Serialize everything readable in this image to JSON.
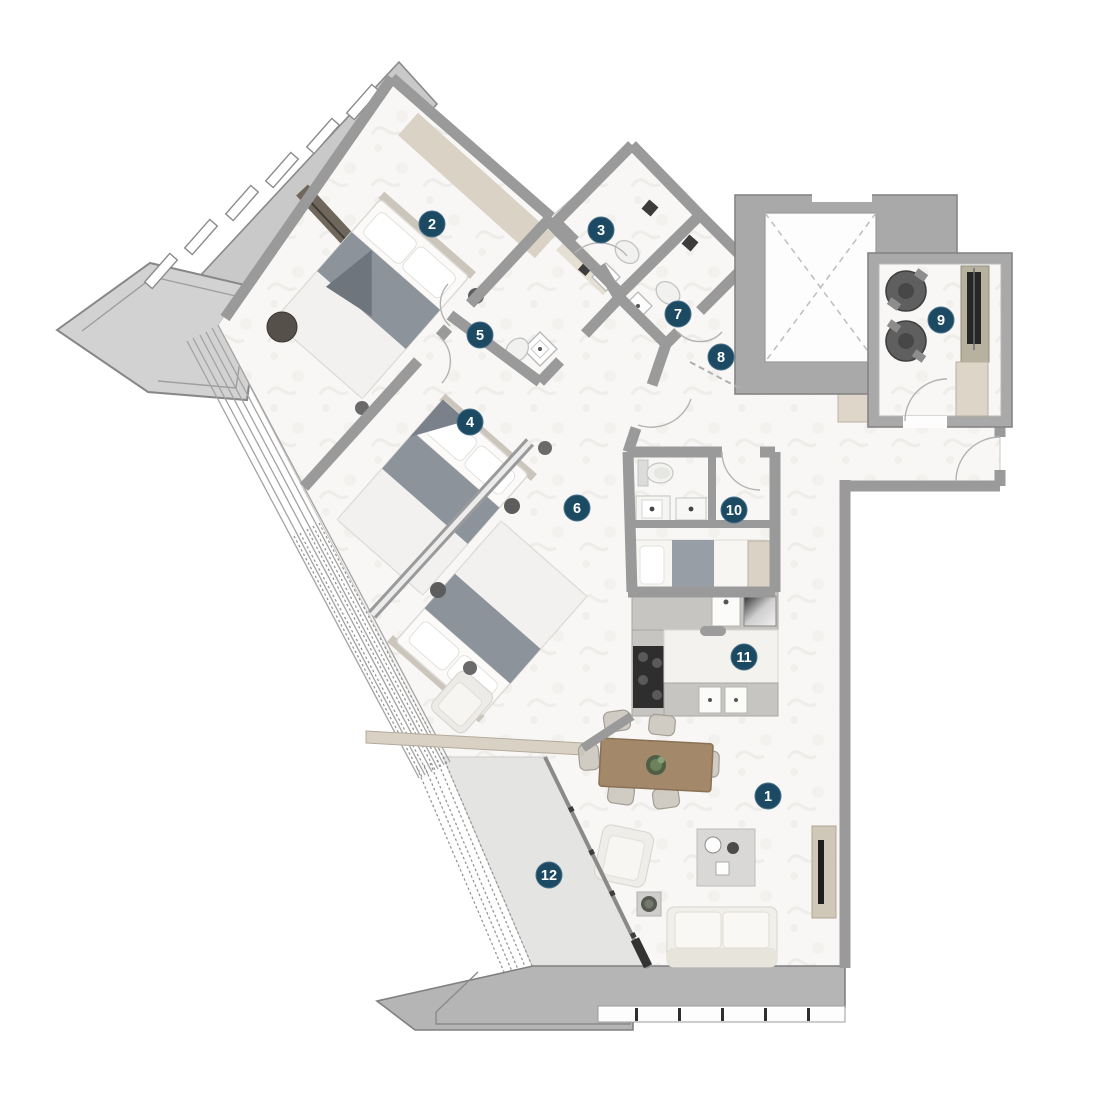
{
  "floorplan": {
    "markers": [
      {
        "n": "1"
      },
      {
        "n": "2"
      },
      {
        "n": "3"
      },
      {
        "n": "4"
      },
      {
        "n": "5"
      },
      {
        "n": "6"
      },
      {
        "n": "7"
      },
      {
        "n": "8"
      },
      {
        "n": "9"
      },
      {
        "n": "10"
      },
      {
        "n": "11"
      },
      {
        "n": "12"
      }
    ],
    "colors": {
      "marker_badge": "#1d4a63",
      "marker_text": "#ffffff",
      "walls": "#9a9a9a",
      "floor": "#f8f7f5",
      "terrace_floor": "#e4e4e3",
      "exterior_band": "#b5b5b5",
      "closet_beige": "#d9d2c5",
      "wood_table": "#a3886a",
      "appliance_dark": "#5f5f5f"
    }
  }
}
